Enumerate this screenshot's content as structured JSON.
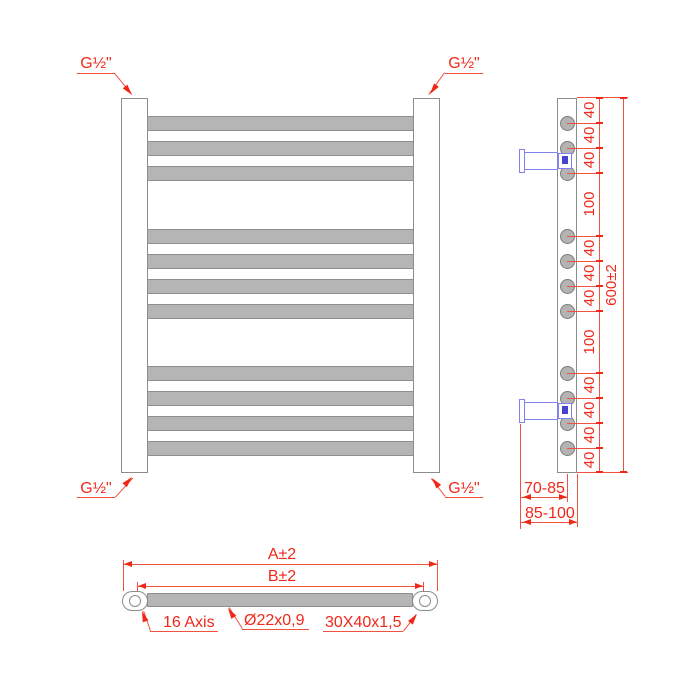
{
  "drawing_type": "towel-radiator technical drawing (front, side and top views)",
  "connections": {
    "top_left": "G½\"",
    "top_right": "G½\"",
    "bottom_left": "G½\"",
    "bottom_right": "G½\""
  },
  "side_view": {
    "spacing_labels": [
      "40",
      "40",
      "40",
      "100",
      "40",
      "40",
      "40",
      "100",
      "40",
      "40",
      "40",
      "40"
    ],
    "spacings_mm": [
      40,
      40,
      40,
      100,
      40,
      40,
      40,
      100,
      40,
      40,
      40,
      40
    ],
    "overall_height_label": "600±2",
    "wall_distance_bracket": "70-85",
    "wall_distance_overall": "85-100",
    "rung_count": 11,
    "rung_groups": [
      3,
      4,
      4
    ]
  },
  "bottom_view": {
    "overall_width_label": "A±2",
    "centers_width_label": "B±2",
    "axis_note": "16 Axis",
    "tube_spec": "Ø22x0,9",
    "profile_spec": "30X40x1,5"
  },
  "colors": {
    "dimension_red": "#f0281a",
    "outline_gray": "#8c8c8c",
    "tube_gray": "#b5b5b5",
    "bracket_blue": "#8181f0",
    "bracket_blue_dark": "#4444cf"
  }
}
